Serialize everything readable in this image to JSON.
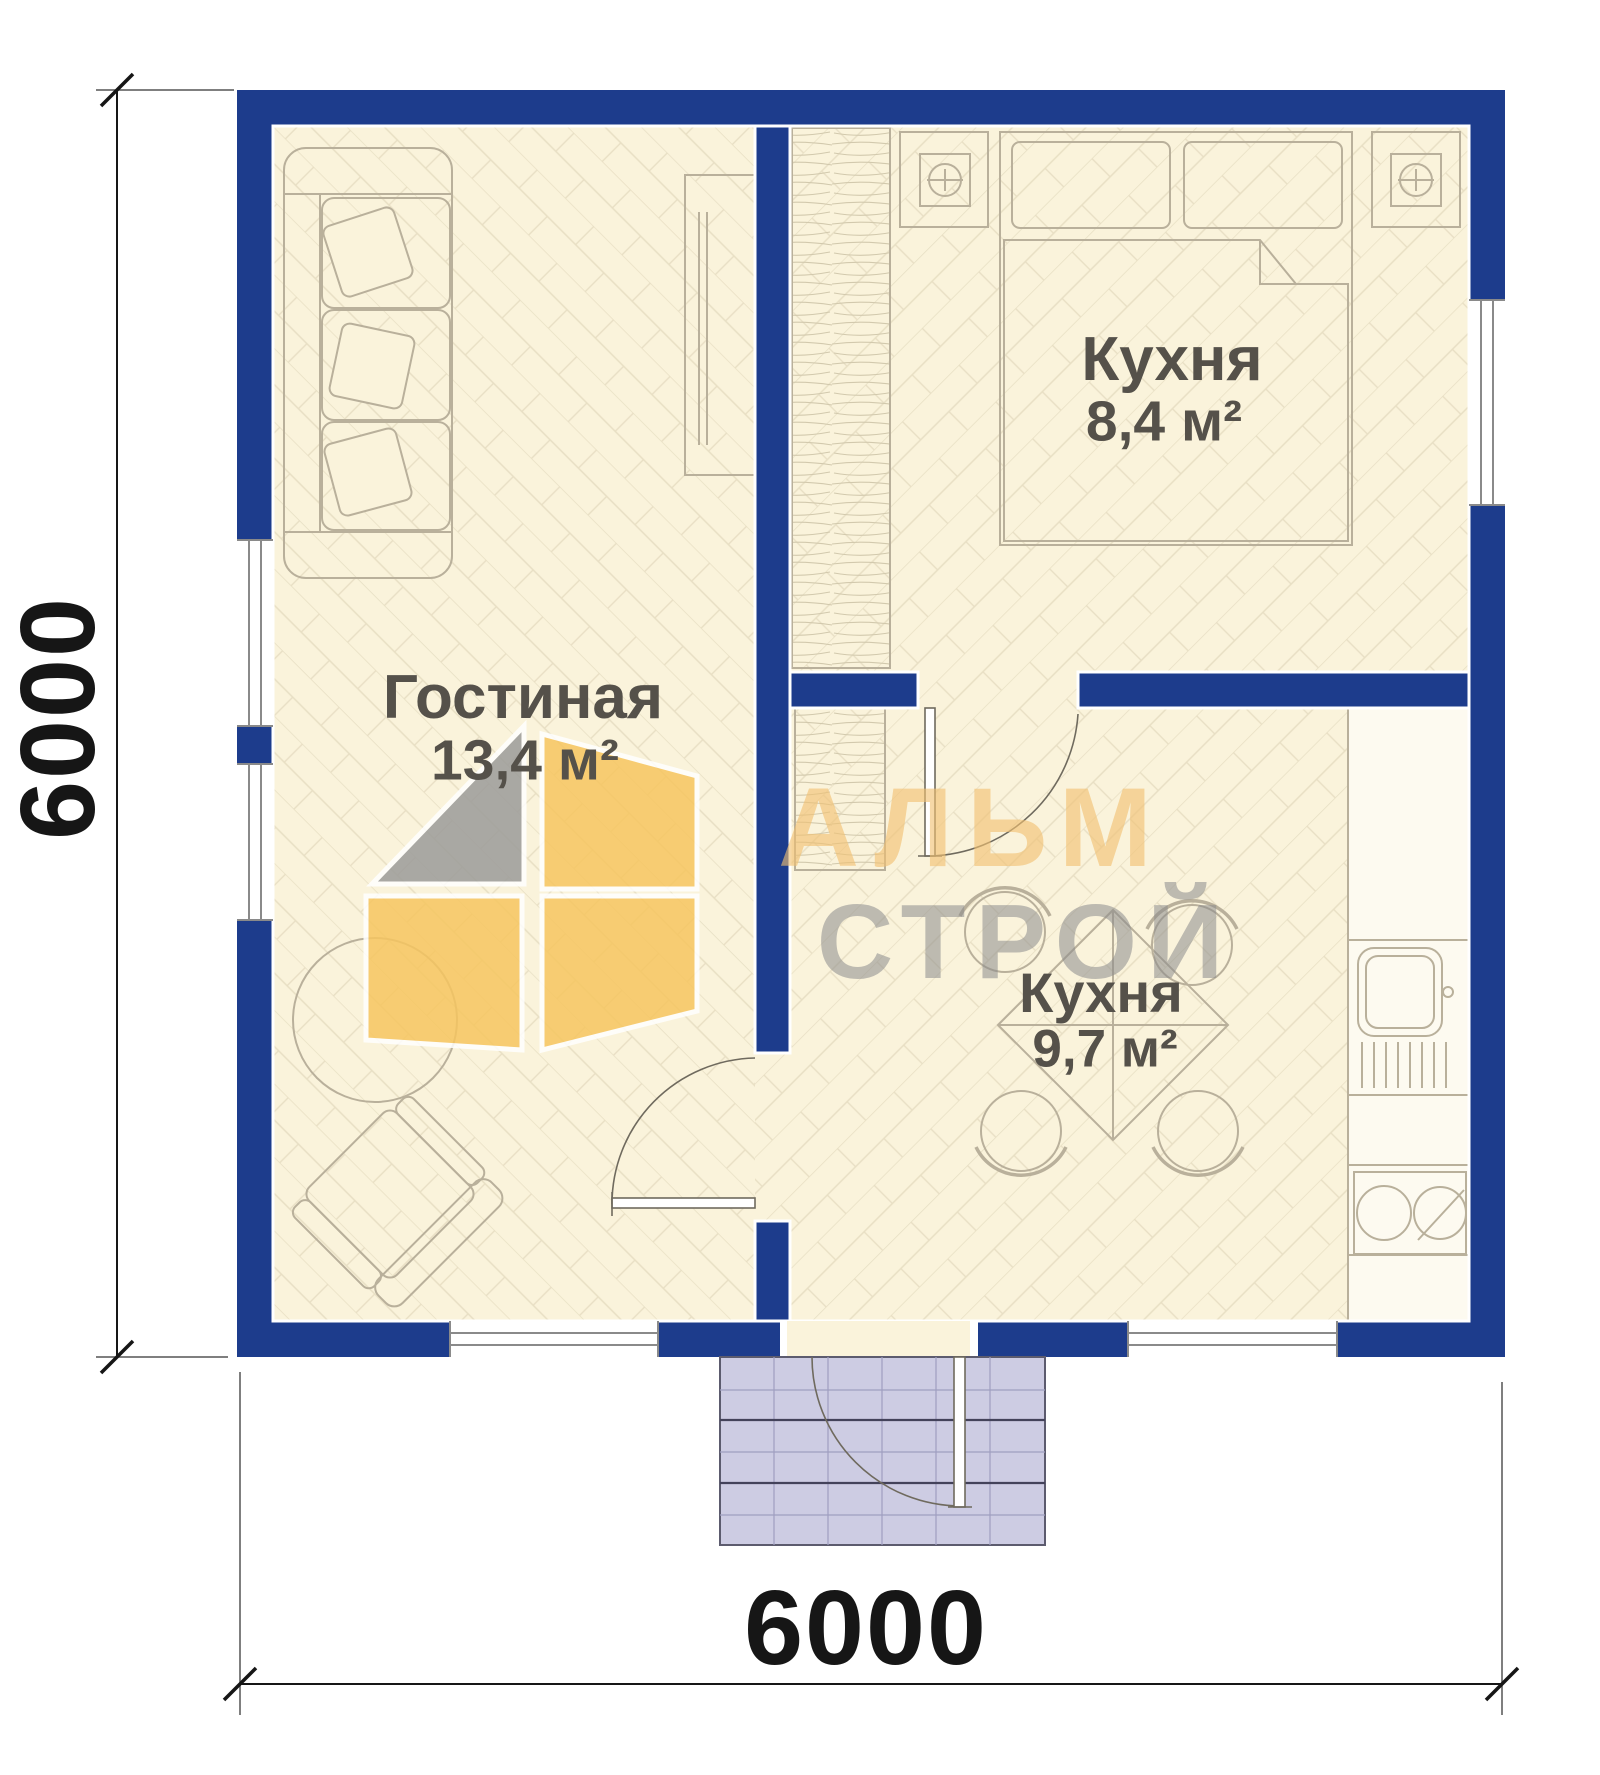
{
  "plan": {
    "rooms": [
      {
        "name": "Гостиная",
        "area": "13,4 м²"
      },
      {
        "name": "Кухня",
        "area": "8,4 м²"
      },
      {
        "name": "Кухня",
        "area": "9,7 м²"
      }
    ],
    "dimensions": {
      "width": "6000",
      "height": "6000"
    },
    "watermark": {
      "line1": "АЛЬМ",
      "line2": "СТРОЙ"
    },
    "colors": {
      "wall": "#1d3c8c",
      "floor": "#faf3db",
      "tile": "#e8dfc4",
      "furn": "#b9b09b",
      "counter": "#fdfaf0",
      "porch": "#cdcce3",
      "porch_line": "#9f9ec0",
      "porch_dark": "#43425a",
      "label": "#55514a",
      "dim": "#161616",
      "wm_yellow": "#f2c172",
      "wm_gray": "#8d8d8d",
      "logo_yellow": "#f7c660",
      "logo_gray": "#9c9c9a",
      "door": "#6f6a5e",
      "window_line": "#8a8a8a"
    }
  }
}
